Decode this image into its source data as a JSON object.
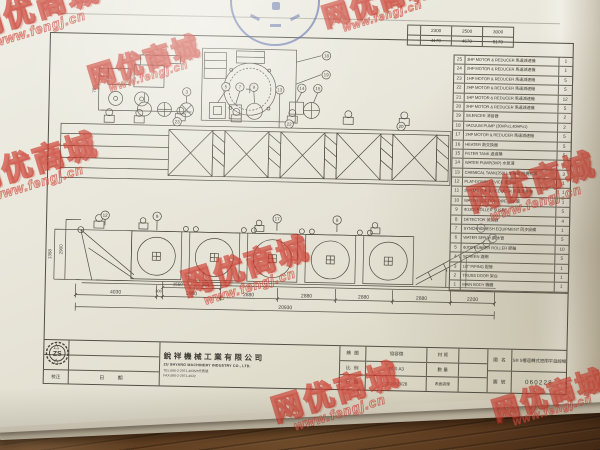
{
  "watermark": {
    "brand": "网优商城",
    "url": "www.fengj.cn"
  },
  "spec_table": {
    "rows": [
      [
        "2300",
        "2500",
        "3000"
      ],
      [
        "4170",
        "4670",
        "5170"
      ]
    ]
  },
  "parts_table": {
    "rows": [
      {
        "no": "25",
        "desc": "3HP MOTOR & REDUCER 馬達減速機",
        "qty": "1"
      },
      {
        "no": "24",
        "desc": "2HP MOTOR & REDUCER 馬達減速機",
        "qty": "1"
      },
      {
        "no": "23",
        "desc": "1HP MOTOR & REDUCER 馬達減速機",
        "qty": "5"
      },
      {
        "no": "22",
        "desc": "2HP MOTOR & REDUCER 馬達減速機",
        "qty": "5"
      },
      {
        "no": "21",
        "desc": "1HP MOTOR & REDUCER 馬達減速機",
        "qty": "12"
      },
      {
        "no": "20",
        "desc": "2HP MOTOR & REDUCER 馬達減速機",
        "qty": "5"
      },
      {
        "no": "19",
        "desc": "SILENCER 消音器",
        "qty": "2"
      },
      {
        "no": "18",
        "desc": "VACUUM PUMP (30HPx1,40HPx1)",
        "qty": "2"
      },
      {
        "no": "17",
        "desc": "2HP MOTOR & REDUCER 馬達減速機",
        "qty": "5"
      },
      {
        "no": "16",
        "desc": "HEATER 熱交換器",
        "qty": "5"
      },
      {
        "no": "15",
        "desc": "FILTER TANK 過濾桶",
        "qty": "5"
      },
      {
        "no": "14",
        "desc": "WATER PUMP(3HP) 水泵浦",
        "qty": "5"
      },
      {
        "no": "13",
        "desc": "CHEMICAL TANK(250L) 加藥桶 附攪拌機",
        "qty": "3"
      },
      {
        "no": "12",
        "desc": "PLAT-DOWN DEVICE 壓平站",
        "qty": "1"
      },
      {
        "no": "11",
        "desc": "2HP MOTOR & REDUCER 馬達減速機",
        "qty": "1"
      },
      {
        "no": "10",
        "desc": "WATER-SUCTION PIPE 吸水管",
        "qty": "1"
      },
      {
        "no": "9",
        "desc": "Φ1200 ROLLER SUS製",
        "qty": "5"
      },
      {
        "no": "8",
        "desc": "DETECTOR 偵測器",
        "qty": "4"
      },
      {
        "no": "7",
        "desc": "SYNCHROMESH EQUIPMENT 同步設備",
        "qty": "1"
      },
      {
        "no": "6",
        "desc": "WATER SPRAY 噴水管",
        "qty": "5"
      },
      {
        "no": "5",
        "desc": "Φ200 RUBBER ROLLER 膠輪",
        "qty": "10"
      },
      {
        "no": "4",
        "desc": "SCREEN 濾網",
        "qty": "5"
      },
      {
        "no": "3",
        "desc": "1/2\" PIPING 配管",
        "qty": "1"
      },
      {
        "no": "2",
        "desc": "TRUSS DOOR 架台",
        "qty": "1"
      },
      {
        "no": "1",
        "desc": "MAIN BODY 機體",
        "qty": "1"
      }
    ]
  },
  "dims": {
    "chain": [
      "4030",
      "300",
      "2880",
      "2880",
      "2880",
      "2880",
      "2880",
      "2200"
    ],
    "sub": [
      "1550",
      "1330"
    ],
    "total": "20930",
    "height_outer": "1358",
    "height_inner": "2900",
    "detail_height": "750"
  },
  "callouts": [
    "18",
    "19",
    "3",
    "5",
    "7",
    "9",
    "13",
    "14",
    "15",
    "23",
    "22",
    "20",
    "9",
    "12",
    "17",
    "8",
    "1",
    "2"
  ],
  "title_block": {
    "logo": "ZS",
    "company_cn": "銳祥機械工業有限公司",
    "company_en": "ZU SHYANG MACHINERY INDUSTRY CO., LTD.",
    "tel": "TEL:886-2-2971-4035/6代表號",
    "fax": "FAX:886-2-2971-4022",
    "revision_marks": [
      "△",
      "△"
    ],
    "labels": {
      "revise": "校正",
      "revise_date": "日 期",
      "drafter": "繪 圖",
      "scale": "比 例",
      "date": "日 期",
      "material": "材 質",
      "qty": "數 量",
      "surface": "表面處理",
      "name": "圖 名",
      "number": "圖 號"
    },
    "values": {
      "drafter": "協容德",
      "scale": "1/80 A3",
      "date": "2006/03/28",
      "material": "",
      "qty": "",
      "surface": "",
      "name": "SR 5槽迴轉式密閉平迴線機",
      "number": "060228"
    }
  }
}
